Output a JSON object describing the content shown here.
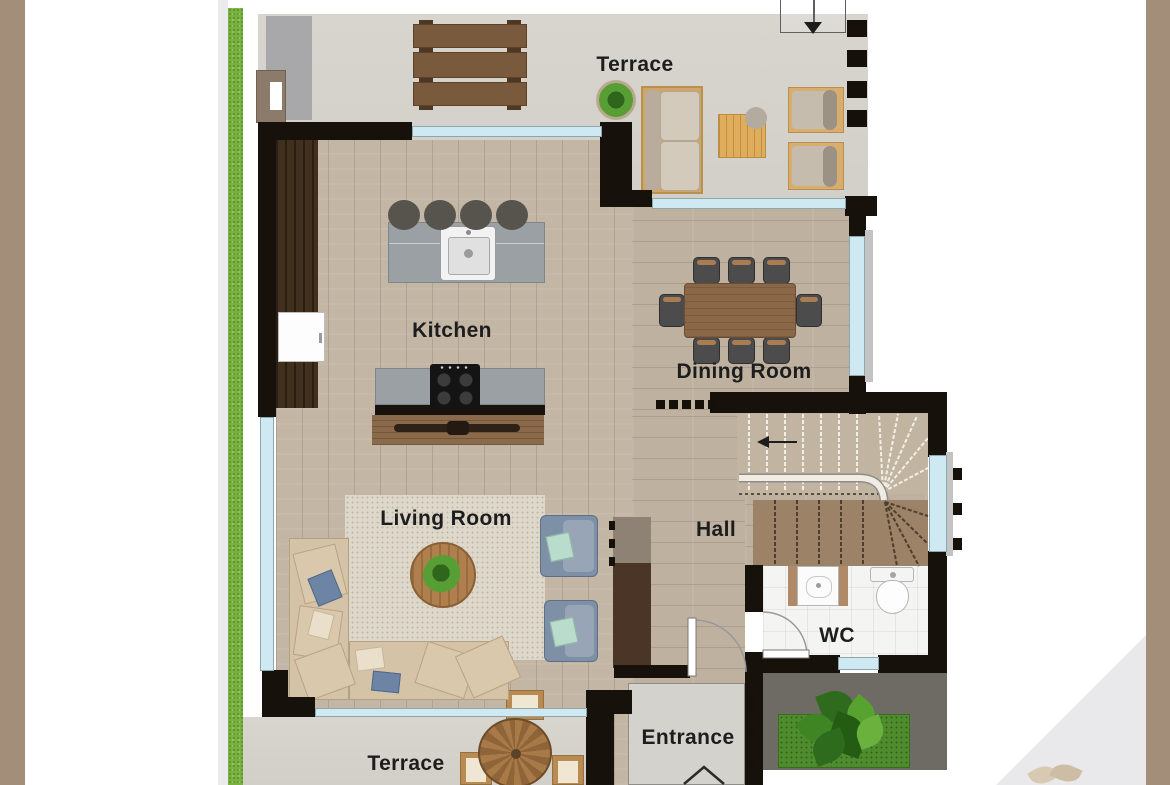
{
  "page": {
    "background": "#ffffff",
    "side_bar_color": "#a38e7a",
    "corner_triangle_color": "#e9e9ec",
    "grass_color": "#79b23f"
  },
  "rooms": {
    "terrace_top": {
      "label": "Terrace"
    },
    "kitchen": {
      "label": "Kitchen"
    },
    "dining_room": {
      "label": "Dining Room"
    },
    "living_room": {
      "label": "Living Room"
    },
    "hall": {
      "label": "Hall"
    },
    "wc": {
      "label": "WC"
    },
    "entrance": {
      "label": "Entrance"
    },
    "terrace_bottom": {
      "label": "Terrace"
    }
  },
  "palette": {
    "wall": "#16110b",
    "window_glass": "#cfe9f2",
    "terrace_concrete": "#d6d3cd",
    "wood_floor": "#c2b4a3",
    "rug": "#ded8ca",
    "sofa_beige": "#d5c3a7",
    "armchair_blue": "#7e90a6",
    "dining_table_wood": "#8a6747",
    "chair_dark_gray": "#4c4c4c",
    "kitchen_counter_gray": "#9aa0a4",
    "cabinet_dark_brown": "#42301f",
    "stairs_upper_wood": "#c1b4a1",
    "stairs_lower_wood": "#9c8266",
    "wc_tile_white": "#f4f4f2",
    "patio_dark_gray": "#6e6a64",
    "planter_green": "#4e8c2e",
    "entrance_pad_gray": "#d4d2cc"
  }
}
